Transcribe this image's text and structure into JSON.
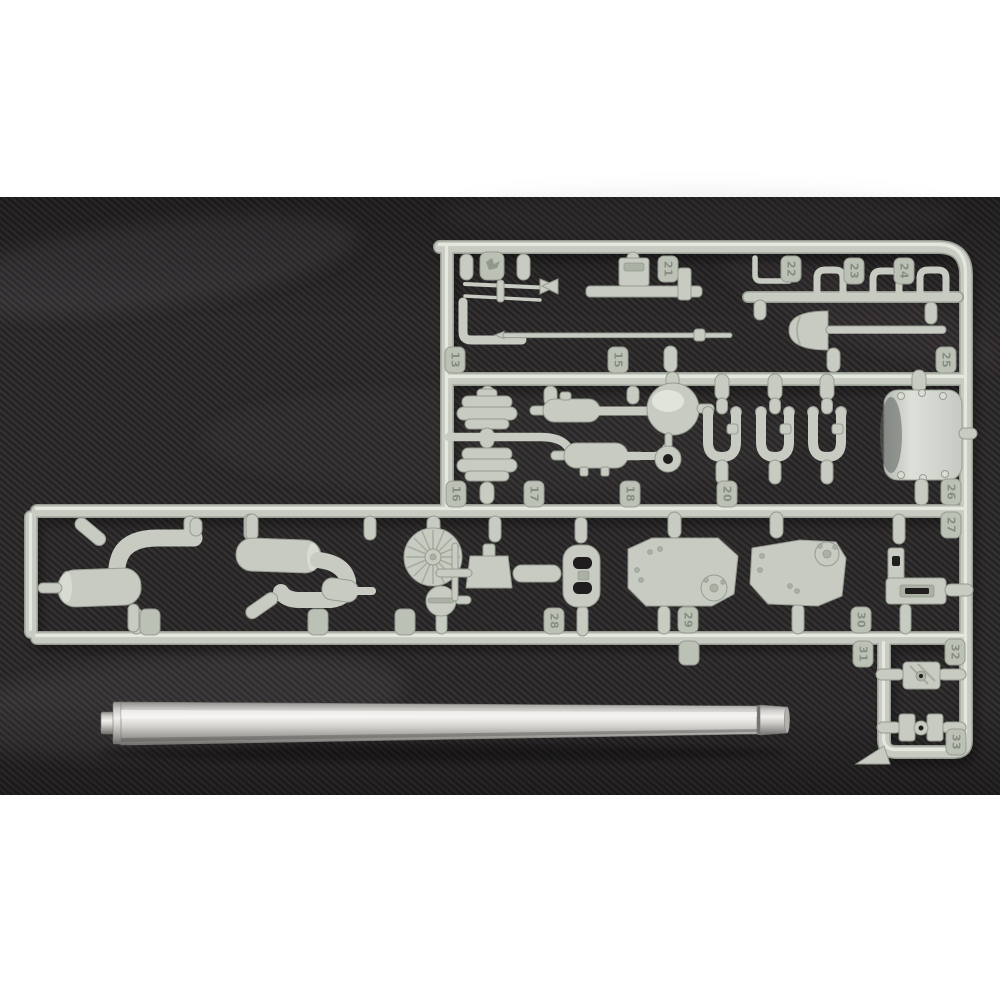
{
  "scene": {
    "type": "product photograph",
    "subject": "light-grey injection-moulded model kit sprue with parts, and a turned aluminum gun barrel, laid on dark charcoal twill fabric",
    "background": "white studio backdrop strips above and below the fabric"
  },
  "colors": {
    "page_bg": "#ffffff",
    "fabric": "#2a2728",
    "plastic": "#c7cbc1",
    "plastic_edge": "#969c91",
    "plastic_dark": "#aab0a4",
    "plastic_hi": "#e9ece3",
    "tab": "#bcc1b6",
    "emboss": "#878d82",
    "bright_part": "#d9ddd6",
    "metal_highlight": "#f1efeb",
    "metal_dark": "#716f6b"
  },
  "sprue": {
    "tabs": [
      "21",
      "22",
      "23",
      "24",
      "25",
      "15",
      "13",
      "16",
      "17",
      "18",
      "20",
      "26",
      "27",
      "28",
      "29",
      "30",
      "31",
      "32",
      "33"
    ],
    "logo_tab": "manufacturer emblem",
    "parts": [
      "tool-rods",
      "periscope-bracket",
      "bent-rod",
      "barrel-clamps-x3",
      "shovel",
      "cleaning-rod",
      "air-cleaners-x2",
      "center-mufflers",
      "dome-cap",
      "washer-ring",
      "tow-shackles-x3",
      "curved-mantlet-cover",
      "exhaust-assembly-left",
      "exhaust-assembly-second",
      "ribbed-wheel",
      "filler-cap",
      "cradle-mount",
      "small-capsule",
      "oval-bracket",
      "flat-plate-x2",
      "angle-bracket",
      "small-fittings-x2"
    ]
  },
  "barrel": {
    "type": "turned metal gun barrel",
    "finish": "aluminum",
    "feature": "stepped muzzle tip at left"
  }
}
